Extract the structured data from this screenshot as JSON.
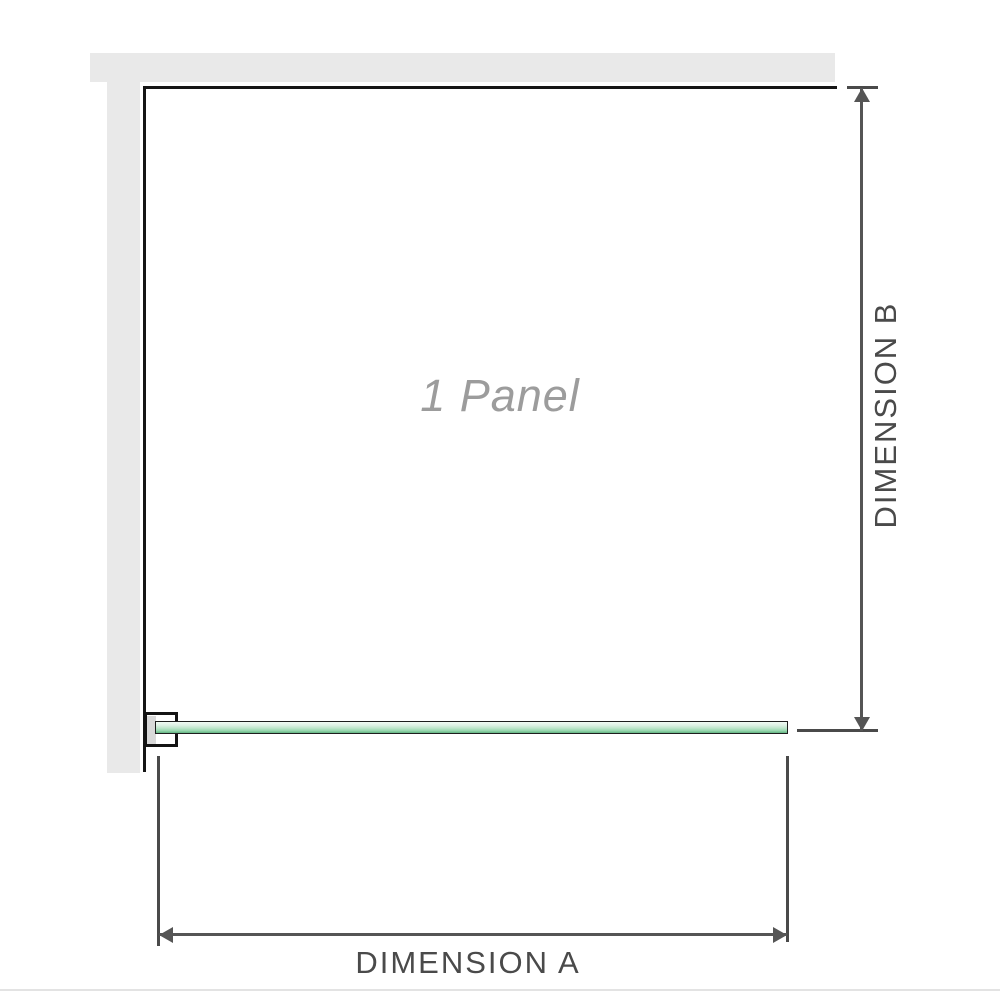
{
  "diagram": {
    "panel_label": "1 Panel",
    "dimension_a_label": "DIMENSION A",
    "dimension_b_label": "DIMENSION B"
  },
  "colors": {
    "wall_gray": "#e9e9e9",
    "frame_black": "#161616",
    "glass_green_light": "#f1faf4",
    "glass_green_mid": "#9bd9b1",
    "glass_green_dark": "#63b384",
    "bracket_insert_gray": "#d9d9d9",
    "dimension_line": "#555555",
    "dimension_text": "#4a4a4a",
    "panel_label_text": "#9c9c9c",
    "divider_gray": "#e3e3e3"
  }
}
